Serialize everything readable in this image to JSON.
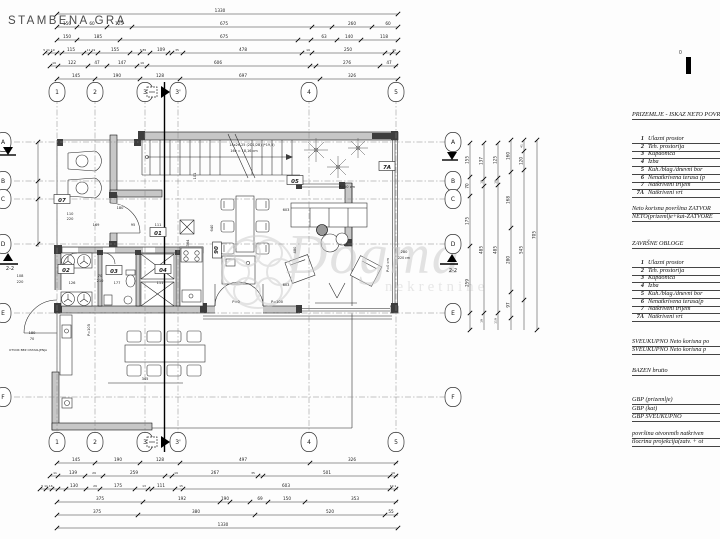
{
  "document": {
    "title": "STAMBENA GRA",
    "scale_zero": "0"
  },
  "legend": {
    "section1_heading": "PRIZEMLJE - ISKAZ NETO POVR",
    "rooms_net": [
      {
        "num": "1",
        "name": "Ulazni prostor"
      },
      {
        "num": "2",
        "name": "Teh. prostorija"
      },
      {
        "num": "3",
        "name": "Kupaonica"
      },
      {
        "num": "4",
        "name": "Izba"
      },
      {
        "num": "5",
        "name": "Kuh./blag./dnevni bor"
      },
      {
        "num": "6",
        "name": "Nenatkrivena terasa (p"
      },
      {
        "num": "7",
        "name": "Natkriveni trijem"
      },
      {
        "num": "7A",
        "name": "Natkriveni vrt"
      }
    ],
    "neto_line1": "Neto korisna površina ZATVOR",
    "neto_line2": "NETO(prizemlje+kat-ZATVORE",
    "section2_heading": "ZAVRŠNE OBLOGE",
    "rooms_finish": [
      {
        "num": "1",
        "name": "Ulazni prostor"
      },
      {
        "num": "2",
        "name": "Teh. prostorija"
      },
      {
        "num": "3",
        "name": "Kupaonica"
      },
      {
        "num": "4",
        "name": "Izba"
      },
      {
        "num": "5",
        "name": "Kuh./blag./dnevni bor"
      },
      {
        "num": "6",
        "name": "Nenatkrivena terasa(p"
      },
      {
        "num": "7",
        "name": "Natkriveni trijem"
      },
      {
        "num": "7A",
        "name": "Natkriveni vrt"
      }
    ],
    "sveukupno1": "SVEUKUPNO Neto korisna po",
    "sveukupno2": "SVEUKUPNO  Neto korisna p",
    "bazen": "BAZEN brutto",
    "gbp": [
      "GBP (prizemlje)",
      "GBP (kat)",
      "GBP SVEUKUPNO"
    ],
    "footer1": "površina otvorenih natkriven",
    "footer2": "tlocrtna projekcija(zatv. + ot"
  },
  "watermark": {
    "word": "Dogma",
    "sub": "nekretnine"
  },
  "plan": {
    "grid_cols": [
      {
        "id": "1",
        "x": 57
      },
      {
        "id": "2",
        "x": 95
      },
      {
        "id": "3",
        "x": 145
      },
      {
        "id": "3'",
        "x": 178
      },
      {
        "id": "4",
        "x": 309
      },
      {
        "id": "5",
        "x": 396
      }
    ],
    "grid_rows": [
      {
        "id": "A",
        "y": 142
      },
      {
        "id": "B",
        "y": 181
      },
      {
        "id": "C",
        "y": 199
      },
      {
        "id": "D",
        "y": 244
      },
      {
        "id": "E",
        "y": 313
      },
      {
        "id": "F",
        "y": 397
      }
    ],
    "section_label": "2-2",
    "dim_rows": [
      {
        "y": 14,
        "x1": 57,
        "x2": 398,
        "ticks": [
          57,
          398
        ],
        "labels": [
          {
            "x": 220,
            "t": "1330"
          }
        ]
      },
      {
        "y": 27,
        "x1": 57,
        "x2": 398,
        "ticks": [
          57,
          77,
          107,
          132,
          312,
          332,
          372,
          398
        ],
        "labels": [
          {
            "x": 67,
            "t": "150"
          },
          {
            "x": 92,
            "t": "60"
          },
          {
            "x": 119,
            "t": "125"
          },
          {
            "x": 224,
            "t": "675"
          },
          {
            "x": 352,
            "t": "260"
          },
          {
            "x": 388,
            "t": "60"
          }
        ]
      },
      {
        "y": 40,
        "x1": 57,
        "x2": 398,
        "ticks": [
          57,
          77,
          120,
          298,
          311,
          337,
          361,
          398
        ],
        "labels": [
          {
            "x": 67,
            "t": "150"
          },
          {
            "x": 98,
            "t": "185"
          },
          {
            "x": 224,
            "t": "675"
          },
          {
            "x": 324,
            "t": "63"
          },
          {
            "x": 349,
            "t": "140"
          },
          {
            "x": 384,
            "t": "118"
          }
        ]
      },
      {
        "y": 53,
        "x1": 45,
        "x2": 398,
        "ticks": [
          45,
          50,
          57,
          62,
          84,
          90,
          98,
          130,
          140,
          150,
          168,
          172,
          183,
          302,
          312,
          385,
          392,
          398
        ],
        "labels": [
          {
            "x": 49,
            "t": "5 11 19",
            "s": 3
          },
          {
            "x": 71,
            "t": "115"
          },
          {
            "x": 91,
            "t": "11 19",
            "s": 3
          },
          {
            "x": 115,
            "t": "155"
          },
          {
            "x": 143,
            "t": "3 85",
            "s": 3
          },
          {
            "x": 161,
            "t": "109"
          },
          {
            "x": 177,
            "t": "35",
            "s": 3
          },
          {
            "x": 243,
            "t": "478"
          },
          {
            "x": 308,
            "t": "19",
            "s": 3
          },
          {
            "x": 348,
            "t": "250"
          },
          {
            "x": 394,
            "t": "19",
            "s": 3
          }
        ]
      },
      {
        "y": 66,
        "x1": 50,
        "x2": 398,
        "ticks": [
          50,
          58,
          88,
          107,
          137,
          147,
          310,
          316,
          380,
          396
        ],
        "labels": [
          {
            "x": 54,
            "t": "19",
            "s": 3
          },
          {
            "x": 72,
            "t": "122"
          },
          {
            "x": 97,
            "t": "47"
          },
          {
            "x": 122,
            "t": "147"
          },
          {
            "x": 142,
            "t": "19",
            "s": 3
          },
          {
            "x": 218,
            "t": "606"
          },
          {
            "x": 347,
            "t": "276"
          },
          {
            "x": 389,
            "t": "47"
          }
        ]
      },
      {
        "y": 79,
        "x1": 57,
        "x2": 398,
        "ticks": [
          57,
          95,
          140,
          180,
          320,
          398
        ],
        "labels": [
          {
            "x": 76,
            "t": "145"
          },
          {
            "x": 117,
            "t": "190"
          },
          {
            "x": 160,
            "t": "128"
          },
          {
            "x": 243,
            "t": "697"
          },
          {
            "x": 352,
            "t": "326"
          }
        ]
      },
      {
        "y": 463,
        "x1": 57,
        "x2": 398,
        "ticks": [
          57,
          95,
          140,
          180,
          310,
          396
        ],
        "labels": [
          {
            "x": 76,
            "t": "145"
          },
          {
            "x": 118,
            "t": "190"
          },
          {
            "x": 160,
            "t": "128"
          },
          {
            "x": 243,
            "t": "497"
          },
          {
            "x": 352,
            "t": "326"
          }
        ]
      },
      {
        "y": 476,
        "x1": 50,
        "x2": 398,
        "ticks": [
          50,
          58,
          85,
          103,
          165,
          172,
          258,
          263,
          390,
          396
        ],
        "labels": [
          {
            "x": 55,
            "t": "11",
            "s": 3
          },
          {
            "x": 73,
            "t": "139"
          },
          {
            "x": 94,
            "t": "29",
            "s": 3
          },
          {
            "x": 134,
            "t": "259"
          },
          {
            "x": 176,
            "t": "19",
            "s": 3
          },
          {
            "x": 215,
            "t": "267"
          },
          {
            "x": 253,
            "t": "35",
            "s": 3
          },
          {
            "x": 327,
            "t": "501"
          },
          {
            "x": 393,
            "t": "19",
            "s": 3
          }
        ]
      },
      {
        "y": 489,
        "x1": 40,
        "x2": 398,
        "ticks": [
          40,
          46,
          52,
          58,
          66,
          86,
          100,
          135,
          148,
          152,
          175,
          183,
          390,
          396
        ],
        "labels": [
          {
            "x": 47,
            "t": "5 11 16",
            "s": 3
          },
          {
            "x": 74,
            "t": "130"
          },
          {
            "x": 95,
            "t": "29",
            "s": 3
          },
          {
            "x": 118,
            "t": "175"
          },
          {
            "x": 144,
            "t": "13",
            "s": 3
          },
          {
            "x": 161,
            "t": "111"
          },
          {
            "x": 181,
            "t": "15",
            "s": 3
          },
          {
            "x": 286,
            "t": "603"
          },
          {
            "x": 393,
            "t": "19 1",
            "s": 3
          }
        ]
      },
      {
        "y": 502,
        "x1": 57,
        "x2": 398,
        "ticks": [
          57,
          143,
          220,
          230,
          250,
          268,
          305,
          396
        ],
        "labels": [
          {
            "x": 100,
            "t": "375"
          },
          {
            "x": 182,
            "t": "192"
          },
          {
            "x": 225,
            "t": "190"
          },
          {
            "x": 260,
            "t": "69"
          },
          {
            "x": 287,
            "t": "150"
          },
          {
            "x": 355,
            "t": "353"
          }
        ]
      },
      {
        "y": 515,
        "x1": 57,
        "x2": 398,
        "ticks": [
          57,
          138,
          255,
          385,
          396
        ],
        "labels": [
          {
            "x": 97,
            "t": "375"
          },
          {
            "x": 196,
            "t": "380"
          },
          {
            "x": 330,
            "t": "520"
          },
          {
            "x": 391,
            "t": "55"
          }
        ]
      },
      {
        "y": 528,
        "x1": 57,
        "x2": 398,
        "ticks": [
          57,
          398
        ],
        "labels": [
          {
            "x": 223,
            "t": "1330"
          }
        ]
      }
    ],
    "dim_cols": [
      {
        "x": 38,
        "y1": 142,
        "y2": 247,
        "ticks": [
          142,
          181,
          199,
          244
        ],
        "labels": []
      },
      {
        "x": 470,
        "y1": 143,
        "y2": 330,
        "ticks": [
          143,
          177,
          196,
          246,
          313,
          330
        ],
        "labels": [
          {
            "y": 160,
            "t": "155"
          },
          {
            "y": 186,
            "t": "70"
          },
          {
            "y": 221,
            "t": "175"
          },
          {
            "y": 283,
            "t": "259"
          }
        ]
      },
      {
        "x": 484,
        "y1": 143,
        "y2": 330,
        "ticks": [
          143,
          179,
          186,
          313
        ],
        "labels": [
          {
            "y": 161,
            "t": "137"
          },
          {
            "y": 182,
            "t": "19",
            "s": 3
          },
          {
            "y": 250,
            "t": "485"
          },
          {
            "y": 321,
            "t": "19",
            "s": 3
          }
        ]
      },
      {
        "x": 498,
        "y1": 143,
        "y2": 330,
        "ticks": [
          143,
          178,
          185,
          313
        ],
        "labels": [
          {
            "y": 160,
            "t": "125"
          },
          {
            "y": 182,
            "t": "19",
            "s": 3
          },
          {
            "y": 250,
            "t": "485"
          },
          {
            "y": 321,
            "t": "119",
            "s": 3
          }
        ]
      },
      {
        "x": 511,
        "y1": 140,
        "y2": 330,
        "ticks": [
          140,
          172,
          228,
          292,
          318
        ],
        "labels": [
          {
            "y": 156,
            "t": "160"
          },
          {
            "y": 200,
            "t": "168"
          },
          {
            "y": 260,
            "t": "280"
          },
          {
            "y": 305,
            "t": "97"
          }
        ]
      },
      {
        "x": 524,
        "y1": 140,
        "y2": 330,
        "ticks": [
          140,
          151,
          170,
          300
        ],
        "labels": [
          {
            "y": 146,
            "t": "41",
            "s": 3
          },
          {
            "y": 161,
            "t": "120"
          },
          {
            "y": 250,
            "t": "545"
          }
        ]
      },
      {
        "x": 537,
        "y1": 140,
        "y2": 330,
        "ticks": [
          140,
          330
        ],
        "labels": [
          {
            "y": 235,
            "t": "705"
          }
        ]
      }
    ],
    "room_labels": [
      {
        "t": "07",
        "x": 62,
        "y": 200
      },
      {
        "t": "01",
        "x": 158,
        "y": 233
      },
      {
        "t": "02",
        "x": 66,
        "y": 270
      },
      {
        "t": "03",
        "x": 114,
        "y": 271
      },
      {
        "t": "04",
        "x": 163,
        "y": 270
      },
      {
        "t": "05",
        "x": 295,
        "y": 181
      },
      {
        "t": "7A",
        "x": 387,
        "y": 167
      },
      {
        "t": "06",
        "x": 216,
        "y": 250,
        "rot": 90
      }
    ],
    "annotations": [
      {
        "x": 252,
        "y": 146,
        "t": "14x26,25 (2D1/2B) (*19,5)",
        "s": 3.4
      },
      {
        "x": 244,
        "y": 152,
        "t": "16v = 18,16 cm",
        "s": 3.4
      },
      {
        "x": 347,
        "y": 188,
        "t": "P=50 cm",
        "s": 3.6
      },
      {
        "x": 236,
        "y": 303,
        "t": "P=0",
        "s": 3.6
      },
      {
        "x": 277,
        "y": 303,
        "t": "P=100",
        "s": 3.6
      },
      {
        "x": 389,
        "y": 265,
        "t": "P=0 cm",
        "s": 3.6,
        "rot": -90
      },
      {
        "x": 90,
        "y": 330,
        "t": "P=105",
        "s": 3.6,
        "rot": -90
      },
      {
        "x": 70,
        "y": 215,
        "t": "110",
        "s": 3.6
      },
      {
        "x": 70,
        "y": 220,
        "t": "220",
        "s": 3.6
      },
      {
        "x": 120,
        "y": 209,
        "t": "180",
        "s": 3.6
      },
      {
        "x": 96,
        "y": 226,
        "t": "169",
        "s": 3.6
      },
      {
        "x": 133,
        "y": 226,
        "t": "95",
        "s": 3.6
      },
      {
        "x": 158,
        "y": 226,
        "t": "111",
        "s": 3.6
      },
      {
        "x": 100,
        "y": 277,
        "t": "70",
        "s": 3.6
      },
      {
        "x": 100,
        "y": 282,
        "t": "210",
        "s": 3.6
      },
      {
        "x": 72,
        "y": 284,
        "t": "126",
        "s": 3.6
      },
      {
        "x": 117,
        "y": 284,
        "t": "177",
        "s": 3.6
      },
      {
        "x": 160,
        "y": 284,
        "t": "111",
        "s": 3.6
      },
      {
        "x": 145,
        "y": 380,
        "t": "345",
        "s": 3.6
      },
      {
        "x": 286,
        "y": 211,
        "t": "603",
        "s": 3.6
      },
      {
        "x": 286,
        "y": 286,
        "t": "603",
        "s": 3.6
      },
      {
        "x": 296,
        "y": 250,
        "t": "480",
        "s": 3.6,
        "rot": -90
      },
      {
        "x": 213,
        "y": 228,
        "t": "640",
        "s": 3.6,
        "rot": -90
      },
      {
        "x": 189,
        "y": 243,
        "t": "364",
        "s": 3.6,
        "rot": -90
      },
      {
        "x": 196,
        "y": 176,
        "t": "101",
        "s": 3.6,
        "rot": -90
      },
      {
        "x": 404,
        "y": 253,
        "t": "280",
        "s": 3.6
      },
      {
        "x": 404,
        "y": 259,
        "t": "220 cm",
        "s": 3.2
      },
      {
        "x": 20,
        "y": 277,
        "t": "108",
        "s": 3.6
      },
      {
        "x": 20,
        "y": 283,
        "t": "220",
        "s": 3.6
      },
      {
        "x": 32,
        "y": 334,
        "t": "180",
        "s": 3.6
      },
      {
        "x": 32,
        "y": 340,
        "t": "70",
        "s": 3.6
      },
      {
        "x": 28,
        "y": 351,
        "t": "OTVOR BEZ OSTAKLJENJA",
        "s": 3
      },
      {
        "x": 10,
        "y": 270,
        "t": "2-2",
        "s": 5
      },
      {
        "x": 453,
        "y": 272,
        "t": "2-2",
        "s": 5
      }
    ]
  }
}
